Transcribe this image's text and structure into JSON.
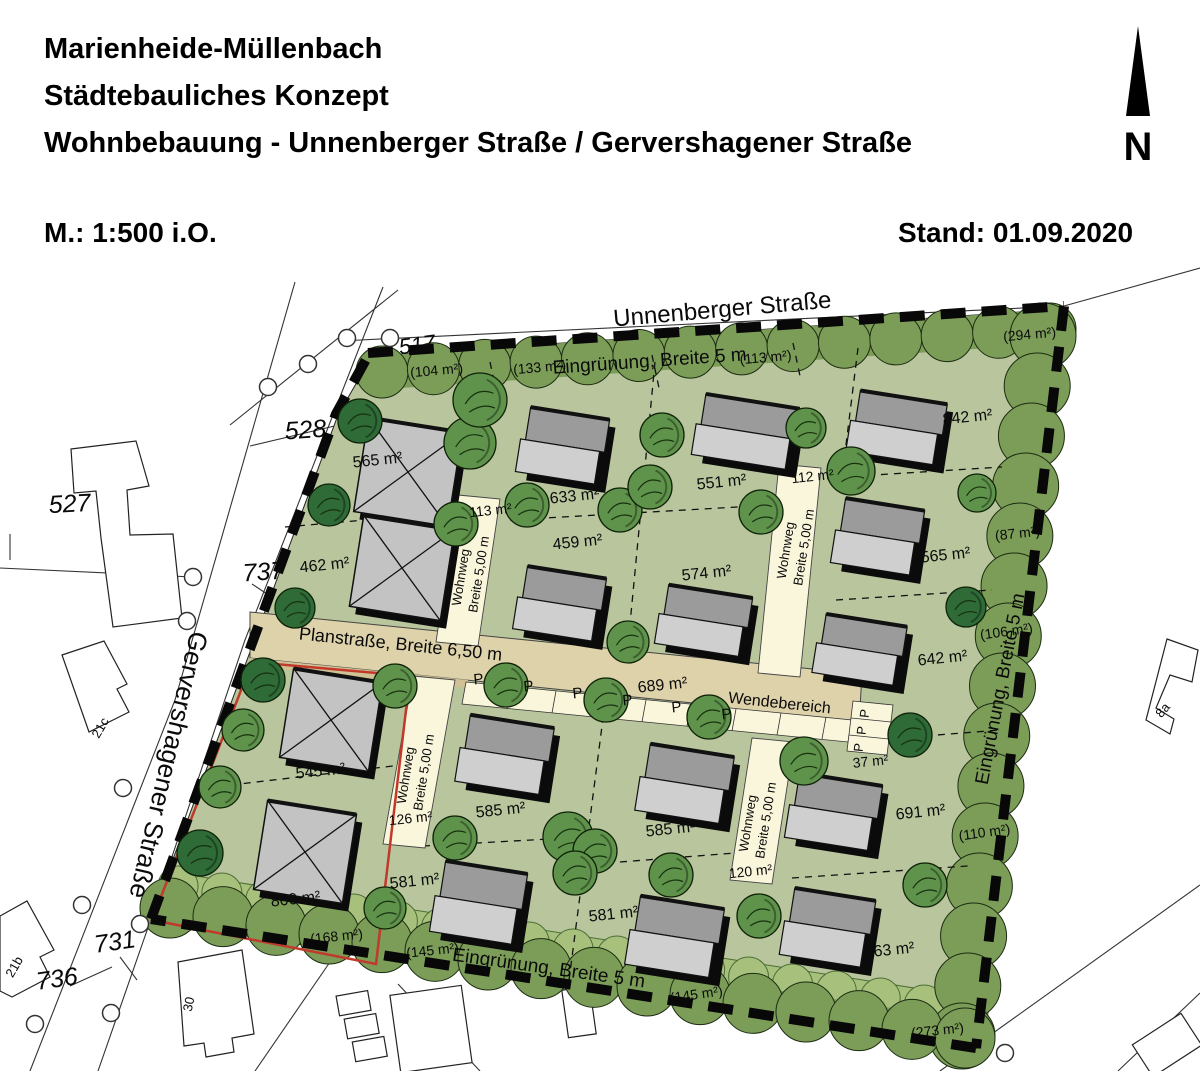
{
  "header": {
    "title_line1": "Marienheide-Müllenbach",
    "title_line2": "Städtebauliches Konzept",
    "title_line3": "Wohnbebauung - Unnenberger Straße / Gervershagener Straße",
    "scale": "M.: 1:500 i.O.",
    "date": "Stand: 01.09.2020",
    "north_label": "N"
  },
  "map": {
    "colors": {
      "site_green": "#b8c59d",
      "hedge_green": "#7c9d58",
      "hedge_stroke": "#1c2c12",
      "light_band": "#a7c17d",
      "light_band_stroke": "#4d6e35",
      "road_tan": "#ded2ab",
      "sidewalk_tan": "#cfc193",
      "path_cream": "#faf6dc",
      "tree_medium": "#5f934b",
      "tree_dark": "#2e6b37",
      "tree_outline": "#0f2208",
      "house_dark": "#9b9b9b",
      "house_light": "#cfcfcf",
      "hip_gray": "#c3c3c3",
      "red_outline": "#c0392b",
      "boundary_black": "#080808"
    },
    "labels": [
      {
        "n": "street-label-unnenberger",
        "t": "Unnenberger Straße",
        "x": 723,
        "y": 317,
        "r": -5,
        "s": 24
      },
      {
        "n": "street-label-gervershagener",
        "t": "Gervershagener Straße",
        "x": 160,
        "y": 763,
        "r": 103,
        "s": 26
      },
      {
        "n": "planstrasse-label",
        "t": "Planstraße, Breite 6,50 m",
        "x": 400,
        "y": 650,
        "r": 6,
        "s": 18
      },
      {
        "n": "wendebereich-label",
        "t": "Wendebereich",
        "x": 779,
        "y": 708,
        "r": 6,
        "s": 16
      },
      {
        "n": "eingruenung-label-top",
        "t": "Eingrünung, Breite 5 m",
        "x": 650,
        "y": 367,
        "r": -4,
        "s": 19
      },
      {
        "n": "eingruenung-label-bottom",
        "t": "Eingrünung, Breite 5 m",
        "x": 548,
        "y": 974,
        "r": 8,
        "s": 19
      },
      {
        "n": "eingruenung-label-right",
        "t": "Eingrünung, Breite 5 m",
        "x": 1006,
        "y": 690,
        "r": -79,
        "s": 19
      },
      {
        "n": "wohnweg-label-nw-line1",
        "t": "Wohnweg",
        "x": 465,
        "y": 578,
        "r": -81,
        "s": 13
      },
      {
        "n": "wohnweg-label-nw-line2",
        "t": "Breite 5,00 m",
        "x": 483,
        "y": 575,
        "r": -81,
        "s": 13
      },
      {
        "n": "wohnweg-label-ne-line1",
        "t": "Wohnweg",
        "x": 790,
        "y": 551,
        "r": -81,
        "s": 13
      },
      {
        "n": "wohnweg-label-ne-line2",
        "t": "Breite 5,00 m",
        "x": 808,
        "y": 548,
        "r": -81,
        "s": 13
      },
      {
        "n": "wohnweg-label-sw-line1",
        "t": "Wohnweg",
        "x": 410,
        "y": 776,
        "r": -81,
        "s": 13
      },
      {
        "n": "wohnweg-label-sw-line2",
        "t": "Breite 5,00 m",
        "x": 428,
        "y": 773,
        "r": -81,
        "s": 13
      },
      {
        "n": "wohnweg-label-se-line1",
        "t": "Wohnweg",
        "x": 752,
        "y": 824,
        "r": -81,
        "s": 13
      },
      {
        "n": "wohnweg-label-se-line2",
        "t": "Breite 5,00 m",
        "x": 770,
        "y": 821,
        "r": -81,
        "s": 13
      },
      {
        "n": "plot-area-label",
        "t": "565 m²",
        "x": 378,
        "y": 465,
        "r": -6,
        "s": 16
      },
      {
        "n": "plot-area-label",
        "t": "462 m²",
        "x": 325,
        "y": 570,
        "r": -6,
        "s": 16
      },
      {
        "n": "plot-area-label",
        "t": "633 m²",
        "x": 575,
        "y": 501,
        "r": -6,
        "s": 16
      },
      {
        "n": "plot-area-label",
        "t": "459 m²",
        "x": 578,
        "y": 547,
        "r": -6,
        "s": 16
      },
      {
        "n": "plot-area-label",
        "t": "551 m²",
        "x": 722,
        "y": 487,
        "r": -6,
        "s": 16
      },
      {
        "n": "plot-area-label",
        "t": "574 m²",
        "x": 707,
        "y": 578,
        "r": -6,
        "s": 16
      },
      {
        "n": "plot-area-label",
        "t": "842 m²",
        "x": 968,
        "y": 422,
        "r": -6,
        "s": 16
      },
      {
        "n": "plot-area-label",
        "t": "565 m²",
        "x": 946,
        "y": 560,
        "r": -6,
        "s": 16
      },
      {
        "n": "plot-area-label",
        "t": "642 m²",
        "x": 943,
        "y": 663,
        "r": -6,
        "s": 16
      },
      {
        "n": "plot-area-label",
        "t": "689 m²",
        "x": 663,
        "y": 690,
        "r": -6,
        "s": 16
      },
      {
        "n": "plot-area-label",
        "t": "545 m²",
        "x": 321,
        "y": 776,
        "r": -6,
        "s": 16
      },
      {
        "n": "plot-area-label",
        "t": "800 m²",
        "x": 296,
        "y": 904,
        "r": -6,
        "s": 16
      },
      {
        "n": "plot-area-label",
        "t": "581 m²",
        "x": 415,
        "y": 886,
        "r": -6,
        "s": 16
      },
      {
        "n": "plot-area-label",
        "t": "585 m²",
        "x": 501,
        "y": 815,
        "r": -6,
        "s": 16
      },
      {
        "n": "plot-area-label",
        "t": "585 m²",
        "x": 671,
        "y": 834,
        "r": -6,
        "s": 16
      },
      {
        "n": "plot-area-label",
        "t": "581 m²",
        "x": 614,
        "y": 919,
        "r": -6,
        "s": 16
      },
      {
        "n": "plot-area-label",
        "t": "691 m²",
        "x": 921,
        "y": 817,
        "r": -6,
        "s": 16
      },
      {
        "n": "plot-area-label",
        "t": "863 m²",
        "x": 890,
        "y": 955,
        "r": -6,
        "s": 16
      },
      {
        "n": "plot-area-label",
        "t": "37 m²",
        "x": 871,
        "y": 766,
        "r": -6,
        "s": 14
      },
      {
        "n": "path-area-label",
        "t": "113 m²",
        "x": 491,
        "y": 515,
        "r": -6,
        "s": 14
      },
      {
        "n": "path-area-label",
        "t": "112 m²",
        "x": 813,
        "y": 481,
        "r": -6,
        "s": 14
      },
      {
        "n": "path-area-label",
        "t": "126 m²",
        "x": 411,
        "y": 823,
        "r": -6,
        "s": 14
      },
      {
        "n": "path-area-label",
        "t": "120 m²",
        "x": 751,
        "y": 876,
        "r": -6,
        "s": 14
      },
      {
        "n": "green-area-label",
        "t": "(104 m²)",
        "x": 437,
        "y": 375,
        "r": -5,
        "s": 14
      },
      {
        "n": "green-area-label",
        "t": "(133 m²)",
        "x": 540,
        "y": 372,
        "r": -5,
        "s": 14
      },
      {
        "n": "green-area-label",
        "t": "(113 m²)",
        "x": 766,
        "y": 362,
        "r": -5,
        "s": 14
      },
      {
        "n": "green-area-label",
        "t": "(294 m²)",
        "x": 1030,
        "y": 339,
        "r": -5,
        "s": 14
      },
      {
        "n": "green-area-label",
        "t": "(87 m²)",
        "x": 1018,
        "y": 538,
        "r": -6,
        "s": 14
      },
      {
        "n": "green-area-label",
        "t": "(106 m²)",
        "x": 1007,
        "y": 636,
        "r": -8,
        "s": 14
      },
      {
        "n": "green-area-label",
        "t": "(110 m²)",
        "x": 985,
        "y": 837,
        "r": -8,
        "s": 14
      },
      {
        "n": "green-area-label",
        "t": "(273 m²)",
        "x": 938,
        "y": 1035,
        "r": -6,
        "s": 14
      },
      {
        "n": "green-area-label",
        "t": "(168 m²)",
        "x": 337,
        "y": 941,
        "r": -6,
        "s": 14
      },
      {
        "n": "green-area-label",
        "t": "(145 m²)",
        "x": 433,
        "y": 955,
        "r": -6,
        "s": 14
      },
      {
        "n": "green-area-label",
        "t": "(145 m²)",
        "x": 697,
        "y": 999,
        "r": -8,
        "s": 14
      },
      {
        "n": "parcel-number",
        "t": "517",
        "x": 418,
        "y": 352,
        "r": -8,
        "s": 22,
        "i": 1
      },
      {
        "n": "parcel-number",
        "t": "528",
        "x": 306,
        "y": 438,
        "r": -4,
        "s": 25,
        "i": 1
      },
      {
        "n": "parcel-number",
        "t": "527",
        "x": 70,
        "y": 512,
        "r": -3,
        "s": 25,
        "i": 1
      },
      {
        "n": "parcel-number",
        "t": "737",
        "x": 264,
        "y": 580,
        "r": -4,
        "s": 25,
        "i": 1
      },
      {
        "n": "parcel-number",
        "t": "731",
        "x": 116,
        "y": 950,
        "r": -8,
        "s": 25,
        "i": 1
      },
      {
        "n": "parcel-number",
        "t": "736",
        "x": 58,
        "y": 987,
        "r": -8,
        "s": 25,
        "i": 1
      },
      {
        "n": "house-number",
        "t": "21c",
        "x": 104,
        "y": 730,
        "r": -60,
        "s": 13
      },
      {
        "n": "house-number",
        "t": "21b",
        "x": 18,
        "y": 969,
        "r": -60,
        "s": 13
      },
      {
        "n": "house-number",
        "t": "30",
        "x": 193,
        "y": 1005,
        "r": -78,
        "s": 13
      },
      {
        "n": "house-number",
        "t": "8a",
        "x": 1166,
        "y": 713,
        "r": -50,
        "s": 13
      }
    ],
    "parking": {
      "letter": "P",
      "row": [
        [
          479,
          684
        ],
        [
          529,
          691
        ],
        [
          578,
          698
        ],
        [
          628,
          705
        ],
        [
          677,
          712
        ],
        [
          727,
          719
        ]
      ],
      "stack": [
        [
          869,
          714
        ],
        [
          866,
          731
        ],
        [
          863,
          748
        ]
      ]
    },
    "houses": [
      {
        "x": 408,
        "y": 472,
        "w": 95,
        "h": 95,
        "t": "hip"
      },
      {
        "x": 402,
        "y": 568,
        "w": 92,
        "h": 92,
        "t": "hip"
      },
      {
        "x": 565,
        "y": 446,
        "w": 80,
        "h": 66,
        "t": "g"
      },
      {
        "x": 562,
        "y": 604,
        "w": 80,
        "h": 64,
        "t": "g"
      },
      {
        "x": 748,
        "y": 432,
        "w": 95,
        "h": 62,
        "t": "g"
      },
      {
        "x": 706,
        "y": 621,
        "w": 85,
        "h": 60,
        "t": "g"
      },
      {
        "x": 899,
        "y": 428,
        "w": 88,
        "h": 62,
        "t": "g"
      },
      {
        "x": 880,
        "y": 537,
        "w": 80,
        "h": 66,
        "t": "g"
      },
      {
        "x": 862,
        "y": 650,
        "w": 82,
        "h": 60,
        "t": "g"
      },
      {
        "x": 331,
        "y": 720,
        "w": 90,
        "h": 90,
        "t": "hip"
      },
      {
        "x": 305,
        "y": 852,
        "w": 90,
        "h": 90,
        "t": "hip"
      },
      {
        "x": 481,
        "y": 903,
        "w": 83,
        "h": 72,
        "t": "g"
      },
      {
        "x": 507,
        "y": 755,
        "w": 85,
        "h": 68,
        "t": "g"
      },
      {
        "x": 687,
        "y": 784,
        "w": 85,
        "h": 68,
        "t": "g"
      },
      {
        "x": 677,
        "y": 937,
        "w": 85,
        "h": 70,
        "t": "g"
      },
      {
        "x": 836,
        "y": 812,
        "w": 84,
        "h": 66,
        "t": "g"
      },
      {
        "x": 830,
        "y": 928,
        "w": 82,
        "h": 68,
        "t": "g"
      }
    ],
    "trees": [
      [
        360,
        421,
        22,
        "d"
      ],
      [
        470,
        443,
        26,
        "m"
      ],
      [
        480,
        400,
        27,
        "m"
      ],
      [
        329,
        505,
        21,
        "d"
      ],
      [
        295,
        608,
        20,
        "d"
      ],
      [
        456,
        524,
        22,
        "m"
      ],
      [
        527,
        505,
        22,
        "m"
      ],
      [
        620,
        510,
        22,
        "m"
      ],
      [
        650,
        487,
        22,
        "m"
      ],
      [
        662,
        435,
        22,
        "m"
      ],
      [
        806,
        428,
        20,
        "m"
      ],
      [
        851,
        471,
        24,
        "m"
      ],
      [
        761,
        512,
        22,
        "m"
      ],
      [
        977,
        493,
        19,
        "m"
      ],
      [
        966,
        607,
        20,
        "d"
      ],
      [
        628,
        642,
        21,
        "m"
      ],
      [
        506,
        685,
        22,
        "m"
      ],
      [
        606,
        700,
        22,
        "m"
      ],
      [
        709,
        717,
        22,
        "m"
      ],
      [
        804,
        761,
        24,
        "m"
      ],
      [
        910,
        735,
        22,
        "d"
      ],
      [
        263,
        680,
        22,
        "d"
      ],
      [
        243,
        730,
        21,
        "m"
      ],
      [
        220,
        787,
        21,
        "m"
      ],
      [
        200,
        853,
        23,
        "d"
      ],
      [
        395,
        686,
        22,
        "m"
      ],
      [
        455,
        838,
        22,
        "m"
      ],
      [
        568,
        837,
        25,
        "m"
      ],
      [
        595,
        851,
        22,
        "m"
      ],
      [
        575,
        873,
        22,
        "m"
      ],
      [
        671,
        875,
        22,
        "m"
      ],
      [
        925,
        885,
        22,
        "m"
      ],
      [
        385,
        908,
        21,
        "m"
      ],
      [
        759,
        916,
        22,
        "m"
      ]
    ]
  }
}
